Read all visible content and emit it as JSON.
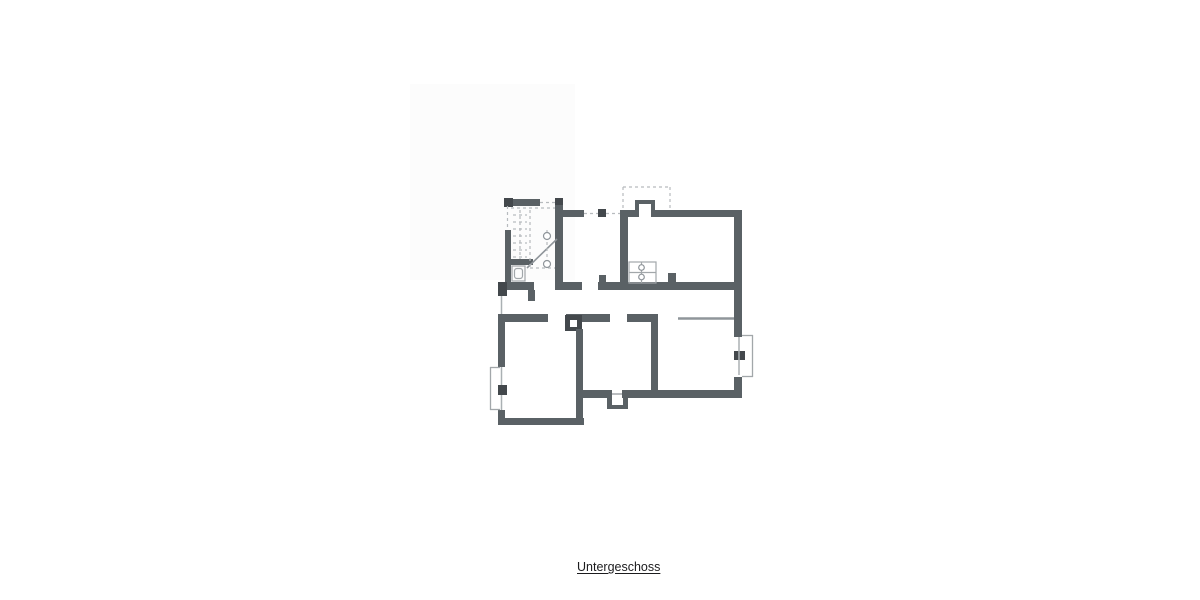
{
  "caption": {
    "text": "Untergeschoss"
  },
  "palette": {
    "wall": "#5a6165",
    "wall_dark": "#43484c",
    "thin": "#a2a7aa",
    "thin_dark": "#8f959a",
    "window": "#aab0b3",
    "dashed": "#b7bbbe",
    "shade": "#fcfcfc",
    "white": "#ffffff",
    "text": "#1c1c1e"
  },
  "floorplan": {
    "shade_rect": {
      "x": 410,
      "y": 84,
      "w": 165,
      "h": 196
    },
    "walls": [
      {
        "n": "wall-top-left",
        "x": 505,
        "y": 199,
        "w": 35,
        "h": 7
      },
      {
        "n": "wall-cap-top-left",
        "x": 504,
        "y": 198,
        "w": 9,
        "h": 9,
        "tone": "wall_dark"
      },
      {
        "n": "wall-stairhall-east",
        "x": 555,
        "y": 198,
        "w": 8,
        "h": 92
      },
      {
        "n": "wall-cap-stairhall",
        "x": 555,
        "y": 198,
        "w": 8,
        "h": 7,
        "tone": "wall_dark"
      },
      {
        "n": "wall-top-mid-a",
        "x": 563,
        "y": 210,
        "w": 21,
        "h": 7
      },
      {
        "n": "door-post",
        "x": 598,
        "y": 209,
        "w": 8,
        "h": 8,
        "tone": "wall_dark"
      },
      {
        "n": "wall-top-mid-b",
        "x": 620,
        "y": 210,
        "w": 15,
        "h": 7
      },
      {
        "n": "wall-midroom-east",
        "x": 620,
        "y": 210,
        "w": 8,
        "h": 80
      },
      {
        "n": "wall-top-right",
        "x": 655,
        "y": 210,
        "w": 79,
        "h": 7
      },
      {
        "n": "wall-east-upper",
        "x": 734,
        "y": 210,
        "w": 8,
        "h": 80
      },
      {
        "n": "chimney-left",
        "x": 635,
        "y": 200,
        "w": 4,
        "h": 17
      },
      {
        "n": "chimney-top",
        "x": 635,
        "y": 200,
        "w": 20,
        "h": 4
      },
      {
        "n": "chimney-right",
        "x": 651,
        "y": 200,
        "w": 4,
        "h": 17
      },
      {
        "n": "wall-corner-west",
        "x": 498,
        "y": 282,
        "w": 9,
        "h": 14,
        "tone": "wall_dark"
      },
      {
        "n": "wall-mid-upper-a",
        "x": 507,
        "y": 282,
        "w": 27,
        "h": 8
      },
      {
        "n": "wall-stub-wc",
        "x": 528,
        "y": 290,
        "w": 7,
        "h": 11
      },
      {
        "n": "wall-mid-upper-b",
        "x": 555,
        "y": 282,
        "w": 27,
        "h": 8
      },
      {
        "n": "wall-mid-upper-c",
        "x": 598,
        "y": 282,
        "w": 144,
        "h": 8
      },
      {
        "n": "wall-jamb-stub",
        "x": 599,
        "y": 275,
        "w": 7,
        "h": 8
      },
      {
        "n": "wall-pier-up",
        "x": 668,
        "y": 273,
        "w": 8,
        "h": 10
      },
      {
        "n": "wall-mid-lower-a",
        "x": 498,
        "y": 314,
        "w": 50,
        "h": 8
      },
      {
        "n": "wall-mid-lower-b",
        "x": 566,
        "y": 314,
        "w": 44,
        "h": 8
      },
      {
        "n": "fixture-box-dark",
        "x": 565,
        "y": 315,
        "w": 17,
        "h": 16,
        "tone": "wall_dark"
      },
      {
        "n": "wall-mid-lower-c",
        "x": 627,
        "y": 314,
        "w": 31,
        "h": 8
      },
      {
        "n": "wall-center-south",
        "x": 651,
        "y": 314,
        "w": 7,
        "h": 84
      },
      {
        "n": "wall-east-mid",
        "x": 734,
        "y": 290,
        "w": 8,
        "h": 47
      },
      {
        "n": "wall-east-low",
        "x": 734,
        "y": 377,
        "w": 8,
        "h": 21
      },
      {
        "n": "window-pier-east",
        "x": 734,
        "y": 351,
        "w": 11,
        "h": 9,
        "tone": "wall_dark"
      },
      {
        "n": "wall-west-upper",
        "x": 498,
        "y": 322,
        "w": 7,
        "h": 45
      },
      {
        "n": "window-pier-west",
        "x": 498,
        "y": 385,
        "w": 9,
        "h": 10,
        "tone": "wall_dark"
      },
      {
        "n": "wall-west-lower",
        "x": 498,
        "y": 410,
        "w": 7,
        "h": 15
      },
      {
        "n": "wall-south-left",
        "x": 498,
        "y": 418,
        "w": 86,
        "h": 7
      },
      {
        "n": "wall-leftroom-east",
        "x": 576,
        "y": 329,
        "w": 7,
        "h": 96
      },
      {
        "n": "wall-south-mid-a",
        "x": 583,
        "y": 390,
        "w": 29,
        "h": 8
      },
      {
        "n": "wall-south-mid-b",
        "x": 622,
        "y": 390,
        "w": 120,
        "h": 8
      },
      {
        "n": "step-left",
        "x": 607,
        "y": 398,
        "w": 5,
        "h": 11
      },
      {
        "n": "step-right",
        "x": 623,
        "y": 398,
        "w": 5,
        "h": 11
      },
      {
        "n": "step-bottom",
        "x": 607,
        "y": 405,
        "w": 21,
        "h": 4
      },
      {
        "n": "wall-stair-west",
        "x": 505,
        "y": 230,
        "w": 6,
        "h": 52
      },
      {
        "n": "wall-wc-divider",
        "x": 511,
        "y": 259,
        "w": 22,
        "h": 6
      }
    ],
    "white_rects": [
      {
        "n": "fixture-box-inner",
        "x": 570,
        "y": 320,
        "w": 7,
        "h": 7
      }
    ],
    "rects_thin": [
      {
        "n": "wc-fixture-outline",
        "x": 512,
        "y": 266,
        "w": 13,
        "h": 15,
        "rx": 0
      },
      {
        "n": "wc-fixture-bowl",
        "x": 514.5,
        "y": 268.5,
        "w": 8,
        "h": 10,
        "rx": 2.5
      },
      {
        "n": "boiler-outline",
        "x": 629,
        "y": 262,
        "w": 27,
        "h": 21,
        "rx": 0
      }
    ],
    "lines": [
      {
        "n": "boiler-mid-line",
        "x1": 629,
        "y1": 272.5,
        "x2": 656,
        "y2": 272.5,
        "w": 1.2,
        "tone": "thin"
      },
      {
        "n": "boiler-center-line",
        "x1": 641.5,
        "y1": 262,
        "x2": 641.5,
        "y2": 283,
        "w": 1.2,
        "tone": "thin"
      },
      {
        "n": "stair-run-line",
        "x1": 527,
        "y1": 268,
        "x2": 557,
        "y2": 239,
        "w": 1.6,
        "tone": "thin_dark"
      },
      {
        "n": "threshold-line",
        "x1": 612,
        "y1": 394,
        "x2": 622,
        "y2": 394,
        "w": 1.5,
        "tone": "thin"
      },
      {
        "n": "opening-line-right",
        "x1": 678,
        "y1": 318.5,
        "x2": 734,
        "y2": 318.5,
        "w": 2.5,
        "tone": "thin_dark"
      },
      {
        "n": "window-line-west-upper",
        "x1": 501.5,
        "y1": 296,
        "x2": 501.5,
        "y2": 314,
        "w": 1.5,
        "tone": "window"
      },
      {
        "n": "window-line-west-a",
        "x1": 501.5,
        "y1": 367,
        "x2": 501.5,
        "y2": 385,
        "w": 1.5,
        "tone": "window"
      },
      {
        "n": "window-line-west-b",
        "x1": 501.5,
        "y1": 395,
        "x2": 501.5,
        "y2": 410,
        "w": 1.5,
        "tone": "window"
      },
      {
        "n": "bay-west-top",
        "x1": 490,
        "y1": 367.5,
        "x2": 500,
        "y2": 367.5,
        "w": 1.3,
        "tone": "thin"
      },
      {
        "n": "bay-west-side",
        "x1": 490.5,
        "y1": 367,
        "x2": 490.5,
        "y2": 410,
        "w": 1.3,
        "tone": "thin"
      },
      {
        "n": "bay-west-bottom",
        "x1": 490,
        "y1": 409.5,
        "x2": 500,
        "y2": 409.5,
        "w": 1.3,
        "tone": "thin"
      },
      {
        "n": "bay-east-top",
        "x1": 742,
        "y1": 335.5,
        "x2": 753,
        "y2": 335.5,
        "w": 1.3,
        "tone": "thin"
      },
      {
        "n": "bay-east-side",
        "x1": 752.5,
        "y1": 335,
        "x2": 752.5,
        "y2": 377,
        "w": 1.3,
        "tone": "thin"
      },
      {
        "n": "bay-east-bottom",
        "x1": 742,
        "y1": 376.5,
        "x2": 753,
        "y2": 376.5,
        "w": 1.3,
        "tone": "thin"
      },
      {
        "n": "window-line-east",
        "x1": 739,
        "y1": 337,
        "x2": 739,
        "y2": 375,
        "w": 1.5,
        "tone": "window"
      }
    ],
    "dashed_lines": [
      {
        "n": "canopy-top",
        "x1": 623,
        "y1": 187,
        "x2": 670,
        "y2": 187
      },
      {
        "n": "canopy-left",
        "x1": 623,
        "y1": 187,
        "x2": 623,
        "y2": 211
      },
      {
        "n": "canopy-right",
        "x1": 670,
        "y1": 187,
        "x2": 670,
        "y2": 211
      },
      {
        "n": "door-dash-a",
        "x1": 584,
        "y1": 213.5,
        "x2": 598,
        "y2": 213.5
      },
      {
        "n": "door-dash-b",
        "x1": 606,
        "y1": 213.5,
        "x2": 620,
        "y2": 213.5
      },
      {
        "n": "door-dash-topleft",
        "x1": 540,
        "y1": 202.5,
        "x2": 555,
        "y2": 202.5
      },
      {
        "n": "stair-dash-top",
        "x1": 511,
        "y1": 208,
        "x2": 555,
        "y2": 208
      },
      {
        "n": "stair-dash-west",
        "x1": 507.5,
        "y1": 206,
        "x2": 507.5,
        "y2": 230
      },
      {
        "n": "stair-dash-v1",
        "x1": 520,
        "y1": 210,
        "x2": 520,
        "y2": 259
      },
      {
        "n": "stair-dash-v2",
        "x1": 530,
        "y1": 210,
        "x2": 530,
        "y2": 268
      },
      {
        "n": "stair-dash-v3",
        "x1": 547,
        "y1": 230,
        "x2": 547,
        "y2": 268
      },
      {
        "n": "stair-dash-bottom",
        "x1": 530,
        "y1": 268,
        "x2": 555,
        "y2": 268
      },
      {
        "n": "stair-tread",
        "x1": 513,
        "y1": 215,
        "x2": 527,
        "y2": 215
      },
      {
        "n": "stair-tread",
        "x1": 513,
        "y1": 222,
        "x2": 527,
        "y2": 222
      },
      {
        "n": "stair-tread",
        "x1": 513,
        "y1": 229,
        "x2": 527,
        "y2": 229
      },
      {
        "n": "stair-tread",
        "x1": 513,
        "y1": 236,
        "x2": 527,
        "y2": 236
      },
      {
        "n": "stair-tread",
        "x1": 513,
        "y1": 243,
        "x2": 527,
        "y2": 243
      },
      {
        "n": "stair-tread",
        "x1": 513,
        "y1": 250,
        "x2": 527,
        "y2": 250
      },
      {
        "n": "stair-tread",
        "x1": 513,
        "y1": 257,
        "x2": 527,
        "y2": 257
      }
    ],
    "circles": [
      {
        "n": "stair-anchor-top",
        "cx": 547,
        "cy": 236,
        "r": 3.5
      },
      {
        "n": "stair-anchor-bottom",
        "cx": 547,
        "cy": 264,
        "r": 3.5
      },
      {
        "n": "boiler-dial-top",
        "cx": 641.5,
        "cy": 267.5,
        "r": 2.8
      },
      {
        "n": "boiler-dial-bottom",
        "cx": 641.5,
        "cy": 277,
        "r": 2.8
      }
    ]
  }
}
